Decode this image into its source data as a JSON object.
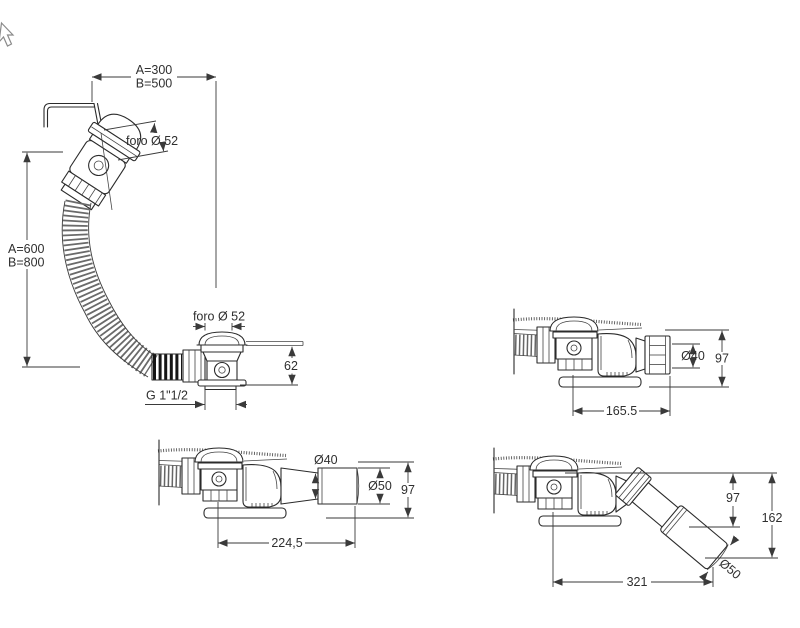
{
  "sheet": {
    "background": "#ffffff",
    "line_color": "#2b2b2b",
    "dim_color": "#3a3a3a"
  },
  "cursor": {
    "icon": "nw-arrow-cursor"
  },
  "main_view": {
    "dim_width_a": "A=300",
    "dim_width_b": "B=500",
    "dim_height_a": "A=600",
    "dim_height_b": "B=800",
    "overflow_hole_label": "foro Ø 52",
    "drain_hole_label": "foro Ø 52",
    "recess_depth": "62",
    "outlet_thread": "G 1\"1/2"
  },
  "view_straight": {
    "outlet_diameter": "Ø40",
    "height": "97",
    "length": "165.5"
  },
  "view_extended": {
    "joint_diameter": "Ø40",
    "outlet_diameter": "Ø50",
    "height": "97",
    "length": "224,5"
  },
  "view_angled": {
    "upper_height": "97",
    "total_height": "162",
    "length": "321",
    "outlet_diameter": "Ø50"
  }
}
